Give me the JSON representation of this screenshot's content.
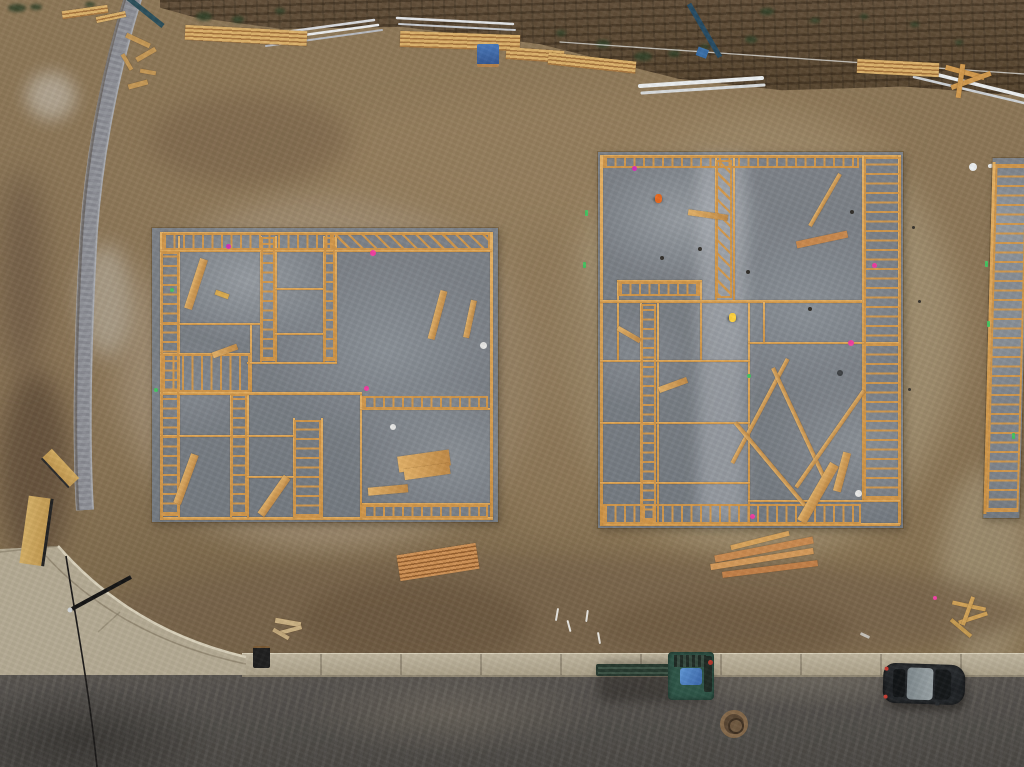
{
  "scene": {
    "kind": "aerial-construction-site-photo",
    "objects": [
      "dirt-lot",
      "terraced-slope",
      "paver-retaining-wall",
      "plywood-fence",
      "concrete-sidewalk",
      "curb-return",
      "asphalt-road",
      "left-house-foundation",
      "right-house-foundation",
      "edge-house-foundation",
      "lumber-piles",
      "pvc-pipes",
      "telehandler",
      "parked-car",
      "manhole-cover",
      "survey-markers",
      "workers"
    ]
  },
  "palette": {
    "dirt": "#8a7456",
    "dirt_light": "#a5947a",
    "dirt_dark": "#5f4c38",
    "slope_band": "#5a4733",
    "slab": "#7d8288",
    "slab_light": "#9aa0a5",
    "framing": "#d0964a",
    "framing_light": "#e6b468",
    "lumber": "#d8a45c",
    "lumber_red": "#c07a42",
    "sidewalk": "#b6ac95",
    "curb_lip": "#d9d1bb",
    "asphalt": "#52504b",
    "paver_wall": "#94969c",
    "pvc": "#e9ebec",
    "car_body": "#232629",
    "car_roof": "#8d969a",
    "machine_green": "#2f5547",
    "tarp_blue": "#4f86c6",
    "marker_pink": "#ef3fa0",
    "marker_green": "#46c261",
    "vest_orange": "#e86a20",
    "hardhat_yellow": "#ffd23e",
    "bush_green": "#33422a"
  },
  "dirt_patches": [
    [
      118,
      196,
      420,
      356,
      "#a39177",
      16,
      0.75
    ],
    [
      560,
      118,
      400,
      440,
      "#a69677",
      16,
      0.7
    ],
    [
      300,
      96,
      600,
      120,
      "#97805f",
      14,
      0.5
    ],
    [
      940,
      470,
      90,
      200,
      "#a89a7d",
      12,
      0.6
    ],
    [
      490,
      230,
      110,
      300,
      "#8d7758",
      12,
      0.55
    ],
    [
      0,
      370,
      70,
      200,
      "#5f4c38",
      12,
      0.8
    ],
    [
      0,
      170,
      45,
      210,
      "#6b5742",
      14,
      0.7
    ],
    [
      100,
      556,
      930,
      112,
      "#77634a",
      10,
      0.8
    ],
    [
      300,
      580,
      230,
      85,
      "#6a563e",
      9,
      0.7
    ],
    [
      600,
      598,
      250,
      62,
      "#6d5940",
      9,
      0.6
    ],
    [
      26,
      72,
      50,
      48,
      "#cdc8be",
      8,
      0.55
    ],
    [
      80,
      244,
      52,
      112,
      "#c3beb2",
      10,
      0.5
    ],
    [
      150,
      95,
      200,
      90,
      "#7b644a",
      12,
      0.6
    ]
  ],
  "bushes": [
    [
      8,
      4,
      18,
      8
    ],
    [
      30,
      4,
      12,
      6
    ],
    [
      85,
      2,
      10,
      5
    ],
    [
      196,
      12,
      16,
      9
    ],
    [
      232,
      16,
      12,
      7
    ],
    [
      275,
      8,
      10,
      6
    ],
    [
      556,
      30,
      10,
      6
    ],
    [
      596,
      40,
      14,
      8
    ],
    [
      634,
      52,
      18,
      9
    ],
    [
      668,
      50,
      12,
      7
    ],
    [
      700,
      44,
      10,
      6
    ],
    [
      745,
      36,
      12,
      7
    ],
    [
      760,
      8,
      14,
      7
    ],
    [
      810,
      18,
      10,
      5
    ],
    [
      860,
      14,
      8,
      5
    ],
    [
      910,
      22,
      9,
      5
    ],
    [
      955,
      40,
      8,
      5
    ]
  ],
  "left_foundation": {
    "x": 152,
    "y": 228,
    "w": 346,
    "h": 294,
    "walls": [
      [
        10,
        4,
        330,
        3
      ],
      [
        338,
        4,
        3,
        288
      ],
      [
        8,
        289,
        333,
        3
      ],
      [
        8,
        4,
        3,
        288
      ],
      [
        26,
        8,
        2,
        281
      ],
      [
        108,
        8,
        2,
        126
      ],
      [
        123,
        8,
        2,
        126
      ],
      [
        171,
        8,
        2,
        126
      ],
      [
        183,
        8,
        2,
        126
      ],
      [
        78,
        164,
        2,
        126
      ],
      [
        95,
        164,
        2,
        126
      ],
      [
        141,
        190,
        2,
        100
      ],
      [
        169,
        190,
        2,
        100
      ],
      [
        208,
        167,
        2,
        124
      ],
      [
        98,
        95,
        2,
        71
      ],
      [
        8,
        22,
        332,
        2
      ],
      [
        8,
        95,
        100,
        2
      ],
      [
        8,
        164,
        202,
        3
      ],
      [
        95,
        134,
        90,
        2
      ],
      [
        8,
        207,
        135,
        2
      ],
      [
        95,
        248,
        48,
        2
      ],
      [
        208,
        180,
        130,
        2
      ],
      [
        210,
        275,
        128,
        2
      ],
      [
        123,
        60,
        48,
        2
      ],
      [
        123,
        105,
        48,
        2
      ],
      [
        8,
        125,
        90,
        2
      ]
    ],
    "ladders": [
      [
        9,
        24,
        18,
        264,
        0
      ],
      [
        10,
        5,
        170,
        17,
        90
      ],
      [
        180,
        5,
        158,
        17,
        45
      ],
      [
        109,
        9,
        14,
        124,
        0
      ],
      [
        172,
        9,
        11,
        124,
        0
      ],
      [
        79,
        166,
        16,
        122,
        0
      ],
      [
        142,
        192,
        27,
        98,
        0
      ],
      [
        210,
        168,
        126,
        13,
        90
      ],
      [
        210,
        277,
        126,
        13,
        90
      ],
      [
        9,
        126,
        89,
        38,
        90
      ]
    ],
    "boards": [
      [
        40,
        30,
        8,
        52,
        18,
        null
      ],
      [
        282,
        62,
        7,
        50,
        15,
        null
      ],
      [
        315,
        72,
        6,
        38,
        12,
        null
      ],
      [
        30,
        225,
        8,
        52,
        20,
        null
      ],
      [
        246,
        225,
        52,
        16,
        -8,
        null
      ],
      [
        252,
        238,
        46,
        11,
        -8,
        null
      ],
      [
        216,
        258,
        40,
        8,
        -5,
        null
      ],
      [
        118,
        245,
        8,
        46,
        35,
        null
      ],
      [
        60,
        120,
        26,
        6,
        -20,
        null
      ]
    ],
    "markers": [
      [
        218,
        22,
        6,
        "#ef3fa0"
      ],
      [
        74,
        16,
        5,
        "#d633b8"
      ],
      [
        212,
        158,
        5,
        "#ef3fa0"
      ],
      [
        328,
        114,
        7,
        "#e8e8e6"
      ],
      [
        238,
        196,
        6,
        "#e8e8e6"
      ],
      [
        18,
        60,
        4,
        "#46c261"
      ],
      [
        2,
        160,
        4,
        "#46c261"
      ]
    ]
  },
  "right_foundation": {
    "x": 598,
    "y": 152,
    "w": 305,
    "h": 376,
    "walls": [
      [
        4,
        3,
        298,
        3
      ],
      [
        300,
        3,
        3,
        370
      ],
      [
        2,
        371,
        300,
        3
      ],
      [
        2,
        3,
        3,
        370
      ],
      [
        117,
        6,
        2,
        142
      ],
      [
        135,
        6,
        2,
        142
      ],
      [
        264,
        4,
        2,
        346
      ],
      [
        59,
        150,
        2,
        221
      ],
      [
        42,
        150,
        2,
        221
      ],
      [
        150,
        150,
        2,
        221
      ],
      [
        102,
        128,
        2,
        80
      ],
      [
        19,
        128,
        2,
        80
      ],
      [
        2,
        148,
        262,
        3
      ],
      [
        19,
        128,
        85,
        2
      ],
      [
        2,
        208,
        150,
        2
      ],
      [
        2,
        270,
        150,
        2
      ],
      [
        150,
        190,
        152,
        2
      ],
      [
        150,
        348,
        152,
        2
      ],
      [
        2,
        330,
        150,
        2
      ],
      [
        165,
        150,
        2,
        40
      ]
    ],
    "ladders": [
      [
        266,
        5,
        37,
        343,
        0
      ],
      [
        118,
        8,
        16,
        138,
        45
      ],
      [
        43,
        152,
        15,
        218,
        0
      ],
      [
        5,
        4,
        256,
        12,
        90
      ],
      [
        5,
        352,
        258,
        20,
        90
      ],
      [
        20,
        130,
        82,
        14,
        90
      ]
    ],
    "boards": [
      [
        198,
        84,
        52,
        7,
        -12,
        "#c9894e"
      ],
      [
        225,
        18,
        4,
        60,
        30,
        null
      ],
      [
        160,
        200,
        4,
        118,
        28,
        null
      ],
      [
        200,
        210,
        4,
        128,
        -25,
        null
      ],
      [
        170,
        258,
        4,
        108,
        -40,
        null
      ],
      [
        230,
        228,
        4,
        118,
        35,
        null
      ],
      [
        215,
        308,
        10,
        66,
        30,
        null
      ],
      [
        240,
        300,
        8,
        40,
        15,
        null
      ],
      [
        60,
        230,
        30,
        6,
        -20,
        null
      ],
      [
        18,
        180,
        26,
        5,
        30,
        null
      ],
      [
        90,
        60,
        40,
        6,
        8,
        null
      ]
    ],
    "markers": [
      [
        34,
        14,
        5,
        "#d633b8"
      ],
      [
        250,
        188,
        6,
        "#ef3fa0"
      ],
      [
        274,
        111,
        5,
        "#ef3fa0"
      ],
      [
        152,
        362,
        5,
        "#ef3fa0"
      ],
      [
        257,
        338,
        7,
        "#e8e8e6"
      ],
      [
        149,
        222,
        4,
        "#46c261"
      ],
      [
        62,
        104,
        4,
        "#33302c"
      ],
      [
        148,
        118,
        4,
        "#33302c"
      ],
      [
        252,
        58,
        4,
        "#33302c"
      ],
      [
        100,
        95,
        4,
        "#33302c"
      ],
      [
        210,
        155,
        4,
        "#33302c"
      ],
      [
        239,
        218,
        6,
        "#3c3f42"
      ]
    ],
    "workers": [
      [
        57,
        42,
        "#e86a20"
      ],
      [
        131,
        161,
        "#ffd23e"
      ]
    ]
  },
  "edge_foundation": {
    "x": 988,
    "y": 158,
    "w": 36,
    "h": 360
  },
  "lumber_piles": {
    "stacks": [
      [
        185,
        28,
        122,
        15,
        3,
        "tan"
      ],
      [
        400,
        33,
        120,
        16,
        2,
        "tan"
      ],
      [
        506,
        49,
        58,
        12,
        4,
        "tan"
      ],
      [
        548,
        57,
        88,
        12,
        6,
        "tan"
      ],
      [
        857,
        61,
        82,
        14,
        3,
        "tan"
      ],
      [
        398,
        549,
        80,
        26,
        -9,
        "red"
      ],
      [
        62,
        8,
        46,
        8,
        -8,
        "tan"
      ],
      [
        96,
        14,
        30,
        6,
        -12,
        "tan"
      ]
    ],
    "sticks": [
      [
        945,
        70,
        40,
        5,
        15,
        "#d29a4e"
      ],
      [
        950,
        78,
        42,
        5,
        -20,
        "#d29a4e"
      ],
      [
        958,
        64,
        5,
        34,
        8,
        "#d29a4e"
      ],
      [
        714,
        546,
        100,
        7,
        -11,
        "#c98a50"
      ],
      [
        710,
        556,
        104,
        6,
        -9,
        "#d49a5a"
      ],
      [
        722,
        566,
        96,
        6,
        -7,
        "#c28048"
      ],
      [
        730,
        538,
        60,
        5,
        -14,
        "#d8a45c"
      ],
      [
        275,
        620,
        26,
        5,
        10,
        "#cbb183"
      ],
      [
        280,
        628,
        22,
        4,
        -15,
        "#cbb183"
      ],
      [
        272,
        632,
        18,
        4,
        30,
        "#c3a97c"
      ],
      [
        952,
        604,
        34,
        4,
        12,
        "#d0a257"
      ],
      [
        958,
        616,
        30,
        4,
        -18,
        "#d0a257"
      ],
      [
        966,
        596,
        4,
        30,
        20,
        "#d0a257"
      ],
      [
        948,
        626,
        26,
        4,
        40,
        "#c59a50"
      ],
      [
        125,
        38,
        26,
        5,
        25,
        "#c59856"
      ],
      [
        135,
        52,
        22,
        5,
        -30,
        "#c59856"
      ],
      [
        118,
        60,
        18,
        4,
        60,
        "#c59856"
      ],
      [
        140,
        70,
        16,
        4,
        10,
        "#c59856"
      ],
      [
        128,
        82,
        20,
        5,
        -15,
        "#c59856"
      ],
      [
        215,
        292,
        14,
        5,
        20,
        "#d8aa50"
      ]
    ]
  },
  "site_markers": [
    [
      556,
      608,
      2,
      13,
      10,
      "#e8e6e0"
    ],
    [
      568,
      620,
      2,
      12,
      -15,
      "#e8e6e0"
    ],
    [
      586,
      610,
      2,
      12,
      8,
      "#e8e6e0"
    ],
    [
      598,
      632,
      2,
      12,
      -10,
      "#e8e6e0"
    ],
    [
      933,
      596,
      4,
      4,
      0,
      "#ef3fa0"
    ],
    [
      585,
      210,
      3,
      6,
      0,
      "#46c261"
    ],
    [
      583,
      262,
      3,
      6,
      0,
      "#46c261"
    ],
    [
      985,
      261,
      3,
      6,
      0,
      "#46c261"
    ],
    [
      987,
      321,
      3,
      6,
      0,
      "#46c261"
    ],
    [
      969,
      163,
      8,
      8,
      0,
      "#eceff0"
    ],
    [
      912,
      226,
      3,
      3,
      0,
      "#3a3630"
    ],
    [
      918,
      300,
      3,
      3,
      0,
      "#3a3630"
    ],
    [
      908,
      388,
      3,
      3,
      0,
      "#3a3630"
    ],
    [
      860,
      634,
      10,
      3,
      25,
      "#c8c4bc"
    ],
    [
      1012,
      433,
      3,
      6,
      0,
      "#46c261"
    ]
  ]
}
